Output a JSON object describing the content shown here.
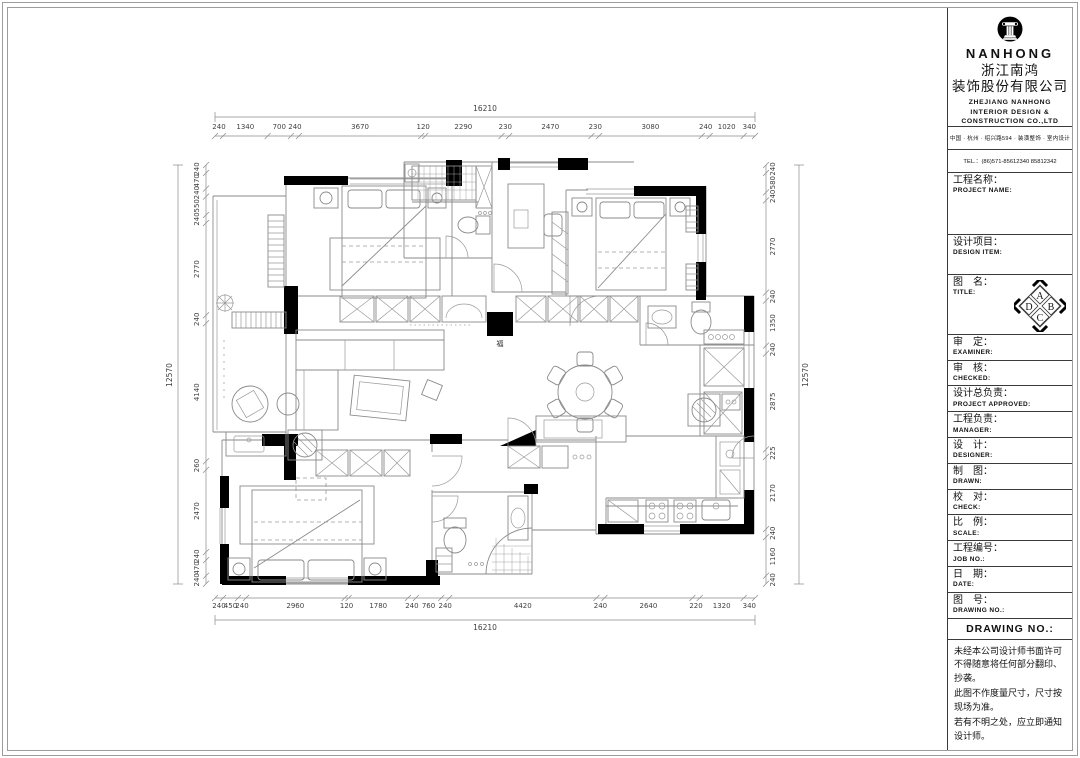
{
  "sheet": {
    "background": "#ffffff",
    "border_color": "#9c9c9c",
    "wall_color": "#000000",
    "line_color": "#8a8a8a"
  },
  "title_block": {
    "brand": {
      "logo": "nanhong-column-logo",
      "name_latin": "NANHONG",
      "name_cn_line1": "浙江南鸿",
      "name_cn_line2": "装饰股份有限公司",
      "name_en_line1": "ZHEJIANG NANHONG",
      "name_en_line2": "INTERIOR DESIGN &",
      "name_en_line3": "CONSTRUCTION CO.,LTD",
      "address": "中国 · 杭州 · 绍兴路594 · 装潢整饰 · 室内设计",
      "tel": "TEL.：(86)571-85612340  85812342"
    },
    "fields": [
      {
        "key": "project-name",
        "cn": "工程名称：",
        "en": "PROJECT NAME:"
      },
      {
        "key": "design-item",
        "cn": "设计项目：",
        "en": "DESIGN ITEM:"
      },
      {
        "key": "title",
        "cn": "图　名：",
        "en": "TITLE:"
      },
      {
        "key": "examiner",
        "cn": "审　定：",
        "en": "EXAMINER:"
      },
      {
        "key": "checked",
        "cn": "审　核：",
        "en": "CHECKED:"
      },
      {
        "key": "project-approved",
        "cn": "设计总负责：",
        "en": "PROJECT APPROVED:"
      },
      {
        "key": "manager",
        "cn": "工程负责：",
        "en": "MANAGER:"
      },
      {
        "key": "designer",
        "cn": "设　计：",
        "en": "DESIGNER:"
      },
      {
        "key": "drawn",
        "cn": "制　图：",
        "en": "DRAWN:"
      },
      {
        "key": "check",
        "cn": "校　对：",
        "en": "CHECK:"
      },
      {
        "key": "scale",
        "cn": "比　例：",
        "en": "SCALE:"
      },
      {
        "key": "job-no",
        "cn": "工程编号：",
        "en": "JOB NO.:"
      },
      {
        "key": "date",
        "cn": "日　期：",
        "en": "DATE:"
      },
      {
        "key": "drawing-no",
        "cn": "图　号：",
        "en": "DRAWING NO.:"
      }
    ],
    "orientation_symbol": {
      "top": "A",
      "right": "B",
      "bottom": "C",
      "left": "D"
    },
    "drawing_no_header": "DRAWING NO.:",
    "notes": [
      "未经本公司设计师书面许可不得随意将任何部分翻印、抄袭。",
      "此图不作度量尺寸，尺寸按现场为准。",
      "若有不明之处，应立即通知设计师。"
    ]
  },
  "plan": {
    "fortune_glyph": "福",
    "dim_total_width": "16210",
    "dim_total_height": "12570",
    "dims_top": [
      "240",
      "1340",
      "700",
      "240",
      "3670",
      "120",
      "2290",
      "230",
      "2470",
      "230",
      "3080",
      "240",
      "1020",
      "340"
    ],
    "dims_bottom": [
      "240",
      "450",
      "240",
      "2960",
      "120",
      "1780",
      "240",
      "760",
      "240",
      "4420",
      "240",
      "2640",
      "220",
      "1320",
      "340"
    ],
    "dims_left": [
      "240",
      "470",
      "240",
      "550",
      "240",
      "2770",
      "240",
      "4140",
      "260",
      "2470",
      "240",
      "470",
      "240"
    ],
    "dims_right": [
      "240",
      "580",
      "240",
      "2770",
      "240",
      "1350",
      "240",
      "2875",
      "225",
      "2170",
      "240",
      "1160",
      "240"
    ]
  }
}
